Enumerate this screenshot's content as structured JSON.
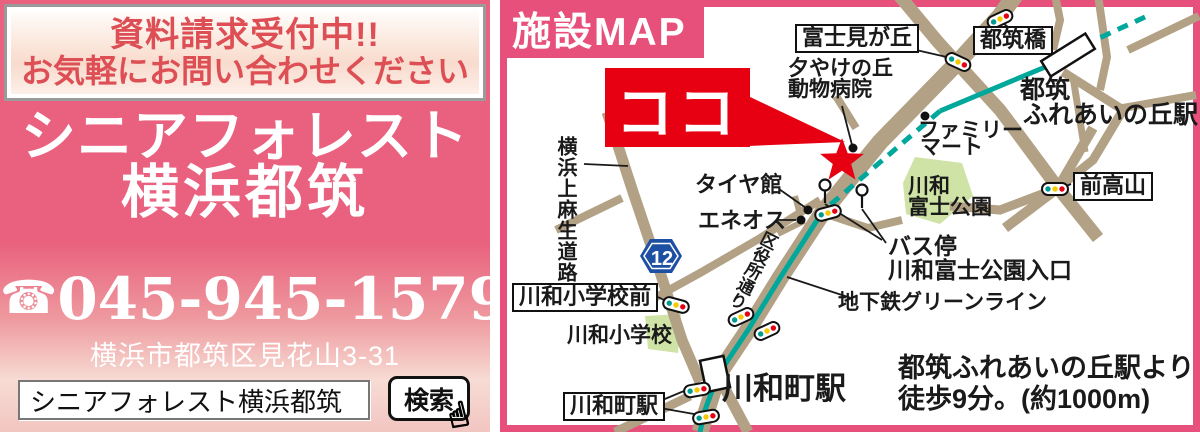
{
  "left_panel": {
    "notice_line1": "資料請求受付中!!",
    "notice_line2": "お気軽にお問い合わせください",
    "title_line1": "シニアフォレスト",
    "title_line2": "横浜都筑",
    "phone_icon_glyph": "☎",
    "phone_number": "045-945-1579",
    "address": "横浜市都筑区見花山3-31",
    "search_value": "シニアフォレスト横浜都筑",
    "search_button_label": "検索",
    "pointer_hand_glyph": "☝"
  },
  "map": {
    "title": "施設MAP",
    "here_label": "ココ",
    "route_badge": "12",
    "walk_note_line1": "都筑ふれあいの丘駅より",
    "walk_note_line2": "徒歩9分。(約1000m)",
    "labels": {
      "fujimigaoka": "富士見が丘",
      "tsuzukibashi": "都筑橋",
      "maetakayama": "前高山",
      "kawawa_shogakko_mae": "川和小学校前",
      "kawawacho_eki_boxed": "川和町駅",
      "yuyake_line1": "夕やけの丘",
      "yuyake_line2": "動物病院",
      "tsuzuki_station_line1": "都筑",
      "tsuzuki_station_line2": "ふれあいの丘駅",
      "familymart_line1": "ファミリー",
      "familymart_line2": "マート",
      "park_line1": "川和",
      "park_line2": "富士公園",
      "tireshop": "タイヤ館",
      "eneos": "エネオス",
      "busstop_line1": "バス停",
      "busstop_line2": "川和富士公園入口",
      "subway_greenline": "地下鉄グリーンライン",
      "kawawa_shogakko": "川和小学校",
      "kawawacho_eki_big": "川和町駅",
      "yokohama_kamiasao_road": "横浜上麻生道路",
      "kuyakusho_dori": "区役所通り"
    },
    "colors": {
      "panel_pink": "#e9617e",
      "frame_pink": "#e7507a",
      "notice_red": "#dd4f55",
      "marker_red": "#e60012",
      "road_tan": "#b2a185",
      "subway_teal": "#00a79b",
      "park_green": "#cfe3a6",
      "route_badge_blue": "#1d50a2"
    }
  }
}
